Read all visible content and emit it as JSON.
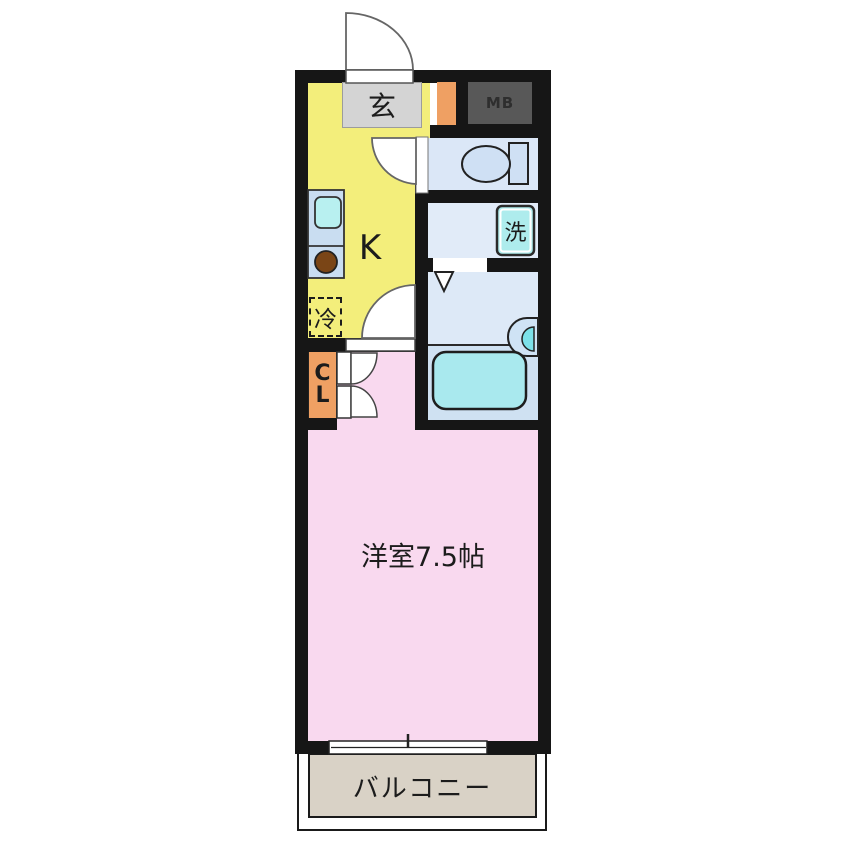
{
  "floor_plan": {
    "type": "apartment-1K-floor-plan",
    "rooms": {
      "entrance": {
        "label": "玄"
      },
      "meter_box": {
        "label": "MB"
      },
      "kitchen": {
        "label": "K"
      },
      "refrigerator": {
        "label": "冷"
      },
      "washer": {
        "label": "洗"
      },
      "closet": {
        "label_line1": "C",
        "label_line2": "L"
      },
      "western_room": {
        "label": "洋室7.5帖",
        "size_tatami": 7.5
      },
      "balcony": {
        "label": "バルコニー"
      }
    },
    "colors": {
      "wall": "#161616",
      "kitchen_yellow": "#f3ee7b",
      "room_pink": "#f9d9ef",
      "entrance_gray": "#d4d4d4",
      "accent_orange": "#efa063",
      "meter_box_gray": "#585858",
      "water_area_blue": "#dbe7f7",
      "fixture_cyan": "#aeeced",
      "bathtub_cyan": "#a9e9ee",
      "balcony_beige": "#d9d2c6"
    }
  }
}
